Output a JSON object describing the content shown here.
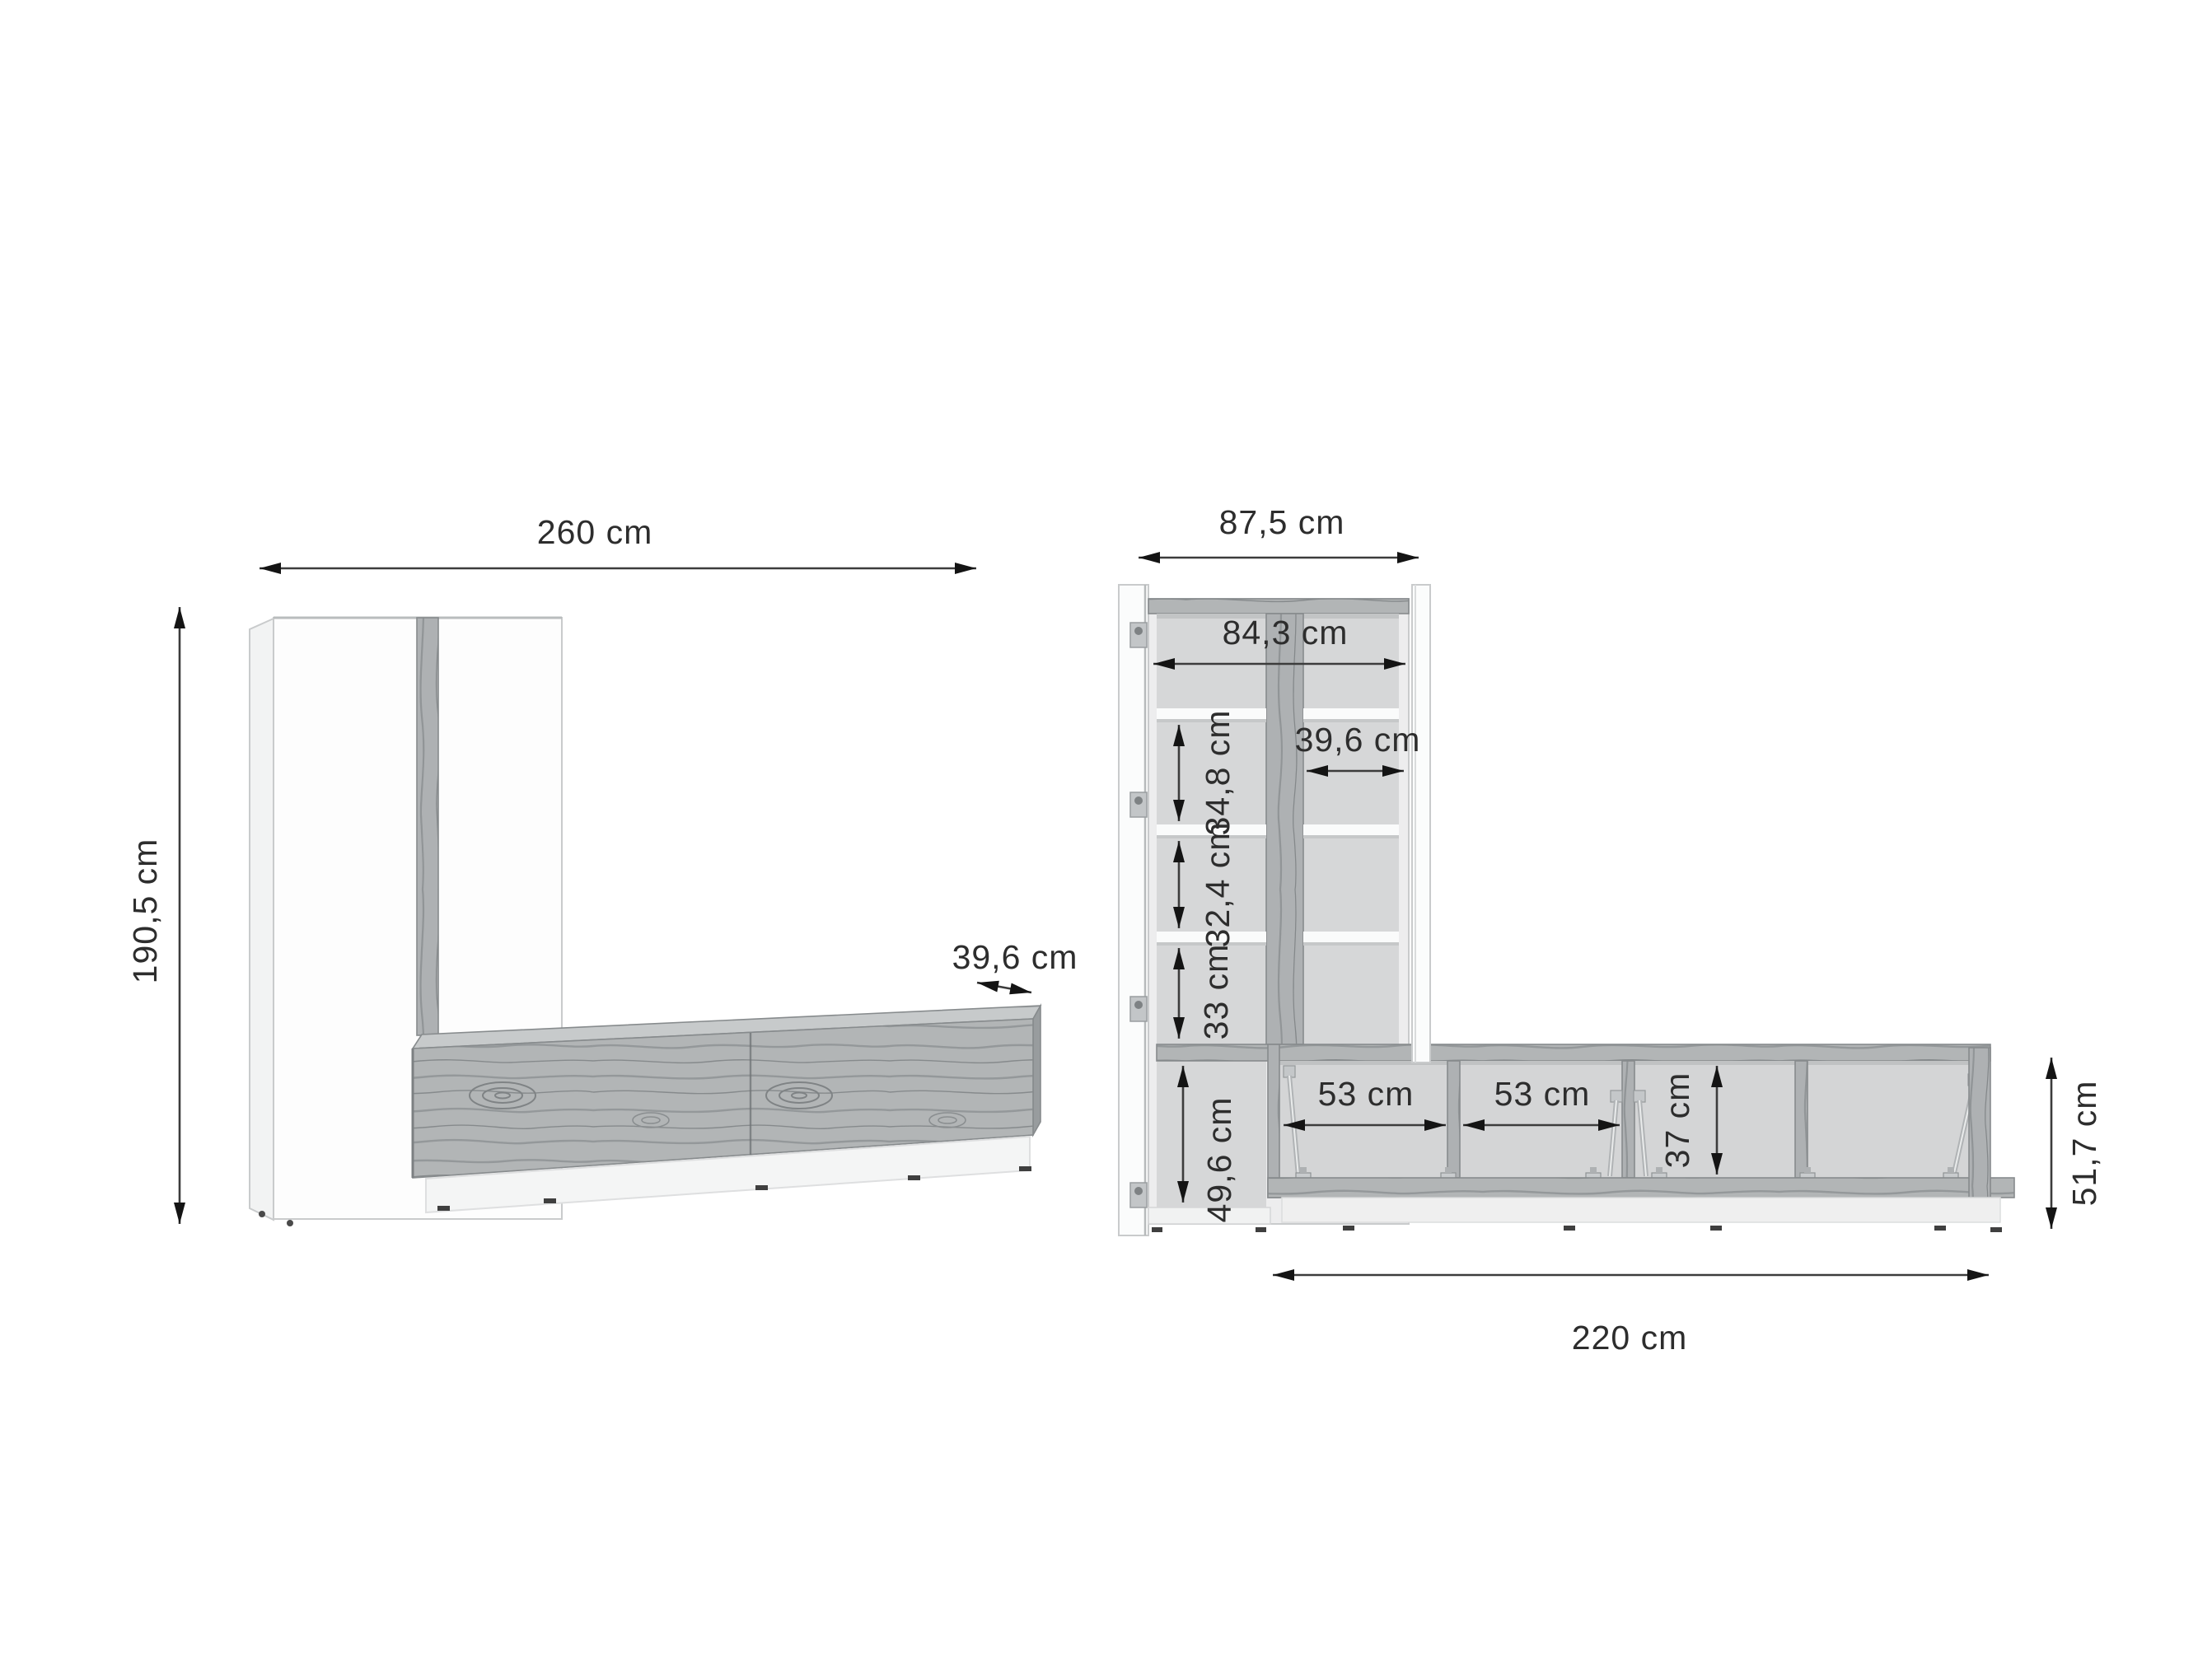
{
  "meta": {
    "diagram_type": "furniture dimension drawing",
    "subject": "wall unit with tall cabinet and TV lowboard",
    "unit": "cm",
    "views": [
      "front view closed",
      "front view open with internal dimensions"
    ]
  },
  "colors": {
    "background": "#ffffff",
    "wood": "#b2b5b6",
    "wood_streak": "#8a8e90",
    "wood_top": "#c7cacb",
    "interior_back": "#d6d7d8",
    "white_panel": "#fbfcfc",
    "dimension_line": "#3c3c3c",
    "text": "#2d2d2d"
  },
  "left_view": {
    "name": "closed front view",
    "dimensions": {
      "total_width": {
        "label": "260 cm",
        "value_cm": 260
      },
      "total_height": {
        "label": "190,5 cm",
        "value_cm": 190.5
      },
      "lowboard_depth": {
        "label": "39,6 cm",
        "value_cm": 39.6
      }
    }
  },
  "right_view": {
    "name": "open view with internal dimensions",
    "dimensions": {
      "cabinet_outer_width": {
        "label": "87,5 cm",
        "value_cm": 87.5
      },
      "cabinet_inner_width": {
        "label": "84,3 cm",
        "value_cm": 84.3
      },
      "cabinet_right_column_width": {
        "label": "39,6 cm",
        "value_cm": 39.6
      },
      "upper_compartment_height": {
        "label": "34,8 cm",
        "value_cm": 34.8
      },
      "middle_compartment_height": {
        "label": "32,4 cm",
        "value_cm": 32.4
      },
      "lower_compartment_height": {
        "label": "33 cm",
        "value_cm": 33
      },
      "base_compartment_height": {
        "label": "49,6 cm",
        "value_cm": 49.6
      },
      "lowboard_compartment_1_width": {
        "label": "53 cm",
        "value_cm": 53
      },
      "lowboard_compartment_2_width": {
        "label": "53 cm",
        "value_cm": 53
      },
      "lowboard_inner_height": {
        "label": "37 cm",
        "value_cm": 37
      },
      "lowboard_outer_height": {
        "label": "51,7 cm",
        "value_cm": 51.7
      },
      "lowboard_total_width": {
        "label": "220 cm",
        "value_cm": 220
      }
    }
  }
}
